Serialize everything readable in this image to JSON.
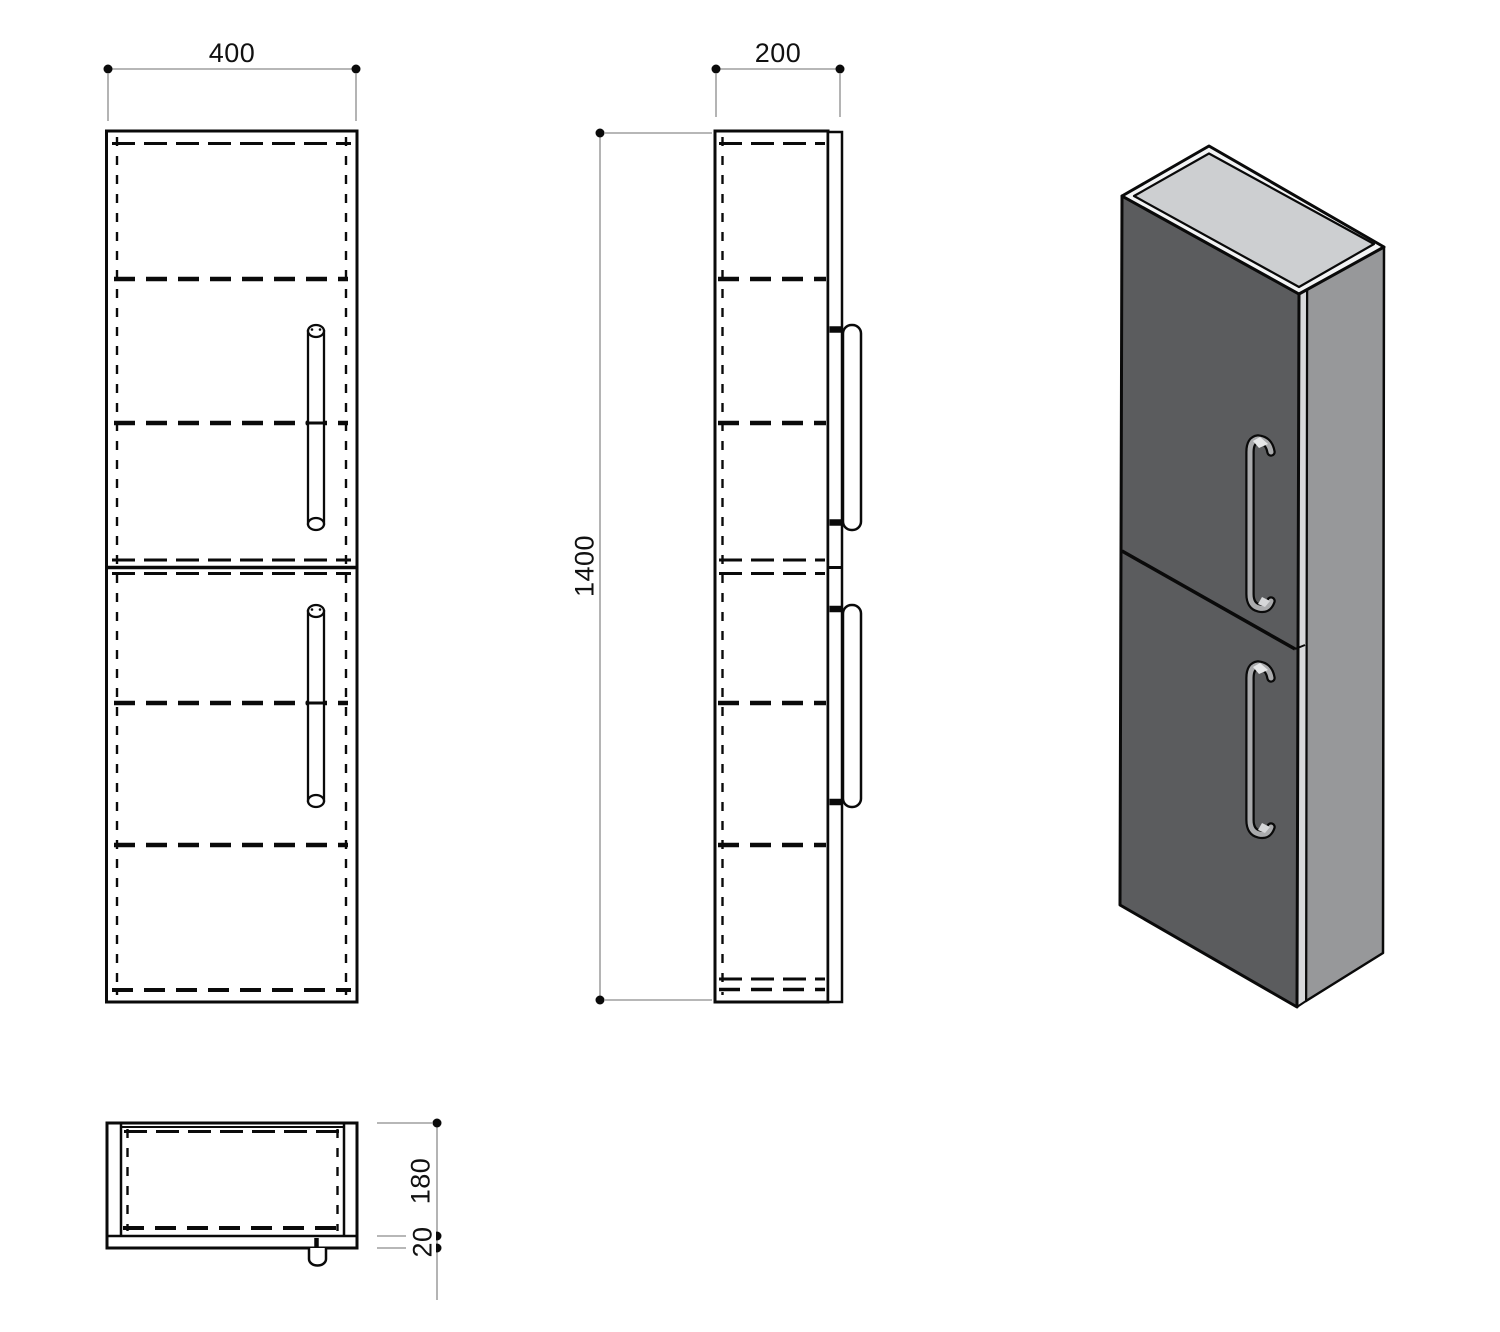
{
  "dimensions": {
    "width": "400",
    "depth": "200",
    "height": "1400",
    "body_depth": "180",
    "plinth": "20"
  },
  "colors": {
    "background": "#ffffff",
    "line": "#0a0a0a",
    "dim_line": "#8c8c8c",
    "front_face": "#5b5c5e",
    "side_face": "#97989a",
    "top_panel": "#cdcfd1",
    "top_rim": "#f3f4f5",
    "edge_strip": "#d8d9db",
    "handle_metal": "#aaabad",
    "handle_highlight": "#e6e7e8"
  }
}
